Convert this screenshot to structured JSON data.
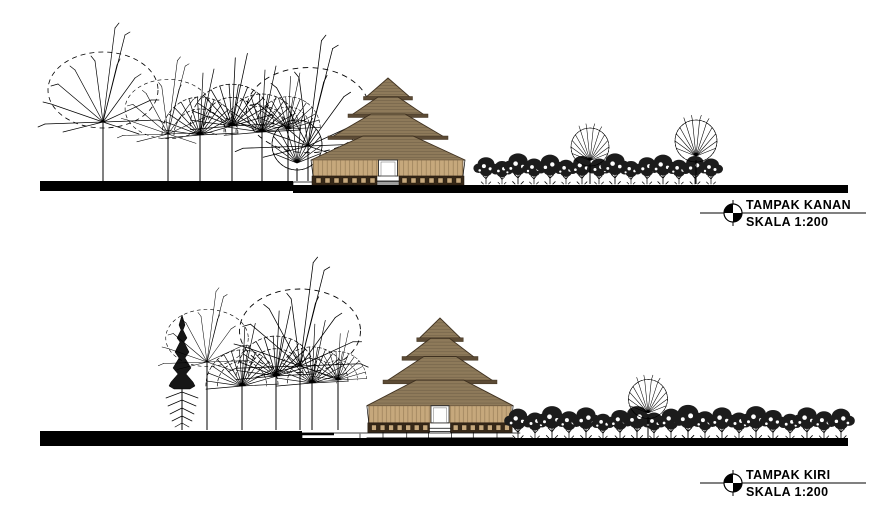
{
  "drawing": {
    "background": "#ffffff",
    "views": [
      {
        "id": "right-elevation",
        "title": "TAMPAK KANAN",
        "scale": "SKALA 1:200",
        "marker_icon": "datum-marker-icon"
      },
      {
        "id": "left-elevation",
        "title": "TAMPAK KIRI",
        "scale": "SKALA 1:200",
        "marker_icon": "datum-marker-icon"
      }
    ]
  },
  "colors": {
    "paper": "#ffffff",
    "ink": "#000000",
    "ground": "#000000",
    "roof_fill": "#8e7a5a",
    "roof_edge": "#3f3120",
    "roof_band": "#5c4b35",
    "wall_fill": "#c6a87c",
    "wall_stroke": "#806a4c",
    "base_fill": "#362818",
    "base_block": "#c6a87c",
    "door_fill": "#ffffff"
  }
}
